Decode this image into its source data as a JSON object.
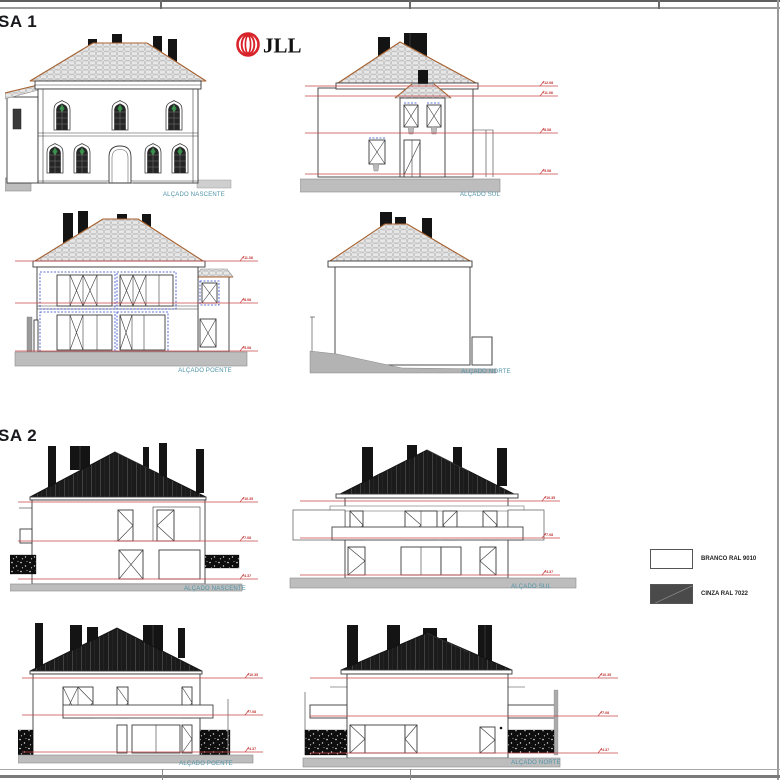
{
  "sheet": {
    "casa1_title": "SA 1",
    "casa2_title": "SA 2",
    "logo_text": "JLL"
  },
  "casa1": {
    "elevations": [
      {
        "label": "ALÇADO NASCENTE",
        "dims": []
      },
      {
        "label": "ALÇADO SUL",
        "dims": [
          "+12.08",
          "+11.08",
          "+8.08",
          "+5.08"
        ]
      },
      {
        "label": "ALÇADO POENTE",
        "dims": [
          "+11.08",
          "+8.08",
          "+5.08"
        ]
      },
      {
        "label": "ALÇADO NORTE",
        "dims": []
      }
    ]
  },
  "casa2": {
    "elevations": [
      {
        "label": "ALÇADO NASCENTE",
        "dims": [
          "+10.35",
          "+7.08",
          "+4.37"
        ]
      },
      {
        "label": "ALÇADO SUL",
        "dims": [
          "+10.35",
          "+7.08",
          "+4.37"
        ]
      },
      {
        "label": "ALÇADO POENTE",
        "dims": [
          "+10.35",
          "+7.08",
          "+4.37"
        ]
      },
      {
        "label": "ALÇADO NORTE",
        "dims": [
          "+10.35",
          "+7.08",
          "+4.37"
        ]
      }
    ]
  },
  "legend": {
    "items": [
      {
        "label": "BRANCO RAL 9010",
        "swatch": "#ffffff"
      },
      {
        "label": "CINZA RAL 7022",
        "swatch": "#4a4a4a"
      }
    ]
  },
  "colors": {
    "dimension_red": "#c94444",
    "label_teal": "#4f93a8",
    "logo_red": "#d8232a",
    "roof_trim_orange": "#a8622f"
  }
}
